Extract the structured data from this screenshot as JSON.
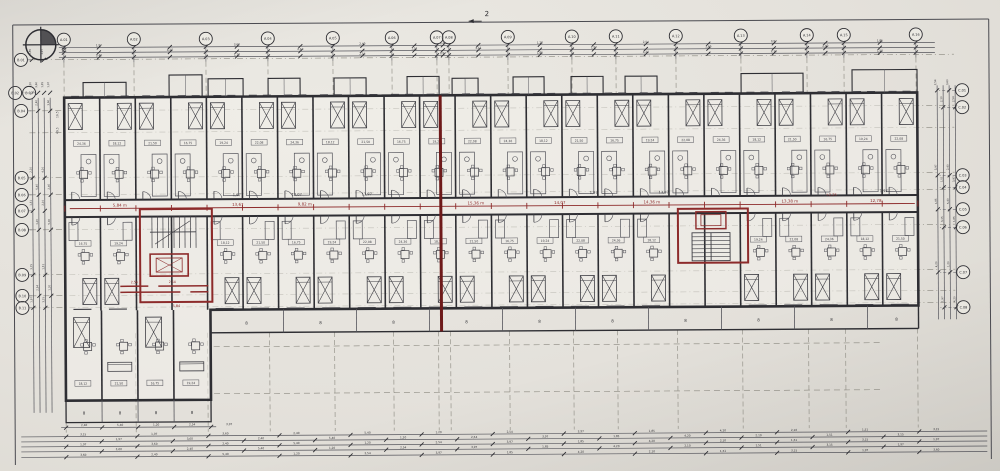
{
  "palette": {
    "paper": "#e4e1db",
    "ink": "#2e2e33",
    "ink_light": "#55555c",
    "ink_faint": "#8a887f",
    "red": "#8d2b2b",
    "red_dark": "#6e1a1a"
  },
  "annotations": {
    "section_marker": "2",
    "north_label": "N",
    "elevation_note": "+2,25",
    "margin_notes": [
      "16,5",
      "49,5"
    ],
    "stair_core_note": "5,84",
    "wing_red_dims": [
      "2,54",
      "2,54"
    ]
  },
  "grid": {
    "top": [
      {
        "x": 65,
        "label": "A.01"
      },
      {
        "x": 135,
        "label": "A.02"
      },
      {
        "x": 207,
        "label": "A.03"
      },
      {
        "x": 269,
        "label": "A.04"
      },
      {
        "x": 334,
        "label": "A.05"
      },
      {
        "x": 393,
        "label": "A.06"
      },
      {
        "x": 438,
        "label": "A.07"
      },
      {
        "x": 450,
        "label": "A.08"
      },
      {
        "x": 509,
        "label": "A.09"
      },
      {
        "x": 573,
        "label": "A.10"
      },
      {
        "x": 617,
        "label": "A.11"
      },
      {
        "x": 677,
        "label": "A.12"
      },
      {
        "x": 742,
        "label": "A.13"
      },
      {
        "x": 808,
        "label": "A.14"
      },
      {
        "x": 845,
        "label": "A.15"
      },
      {
        "x": 917,
        "label": "A.16"
      }
    ],
    "left": [
      {
        "y": 57,
        "label": "B.01"
      },
      {
        "y": 90,
        "label": "B.02",
        "x": 16
      },
      {
        "y": 90,
        "label": "B.03",
        "x": 30
      },
      {
        "y": 108,
        "label": "B.04"
      },
      {
        "y": 175,
        "label": "B.05"
      },
      {
        "y": 192,
        "label": "B.06"
      },
      {
        "y": 208,
        "label": "B.07"
      },
      {
        "y": 227,
        "label": "B.08"
      },
      {
        "y": 272,
        "label": "B.09"
      },
      {
        "y": 293,
        "label": "B.10"
      },
      {
        "y": 305,
        "label": "B.11"
      }
    ],
    "right": [
      {
        "y": 93,
        "label": "C.01"
      },
      {
        "y": 110,
        "label": "C.02"
      },
      {
        "y": 178,
        "label": "C.03"
      },
      {
        "y": 190,
        "label": "C.04"
      },
      {
        "y": 212,
        "label": "C.05"
      },
      {
        "y": 230,
        "label": "C.06"
      },
      {
        "y": 275,
        "label": "C.07"
      },
      {
        "y": 310,
        "label": "C.08"
      }
    ]
  },
  "corridor": {
    "red_dims": [
      {
        "x": 120,
        "text": "5,84 m"
      },
      {
        "x": 238,
        "text": "13,67"
      },
      {
        "x": 305,
        "text": "9,82 m"
      },
      {
        "x": 476,
        "text": "15,36 m"
      },
      {
        "x": 560,
        "text": "14,07"
      },
      {
        "x": 652,
        "text": "14,36 m"
      },
      {
        "x": 790,
        "text": "13,38 m"
      },
      {
        "x": 876,
        "text": "12,78"
      }
    ],
    "black_dims": [
      {
        "x": 237,
        "text": "1,97"
      },
      {
        "x": 297,
        "text": "13,07"
      },
      {
        "x": 367,
        "text": "13,97"
      },
      {
        "x": 594,
        "text": "1,97"
      },
      {
        "x": 664,
        "text": "13,97"
      },
      {
        "x": 884,
        "text": "1,97"
      }
    ]
  },
  "balconies": {
    "rail_label": "8",
    "bottom_label_xs": [
      246,
      320,
      393,
      466,
      539,
      612,
      685,
      758,
      831,
      896
    ],
    "wing_label_xs": [
      83,
      119,
      155,
      191
    ]
  },
  "micro_dims": [
    "1,97",
    "3,60",
    "2,40",
    "5,40",
    "1,20",
    "2,54",
    "3,97",
    "1,85",
    "4,20",
    "2,10",
    "1,51",
    "3,15"
  ],
  "area_labels": [
    "24,36",
    "18,12",
    "21,50",
    "16,75",
    "19,24",
    "22,08"
  ]
}
